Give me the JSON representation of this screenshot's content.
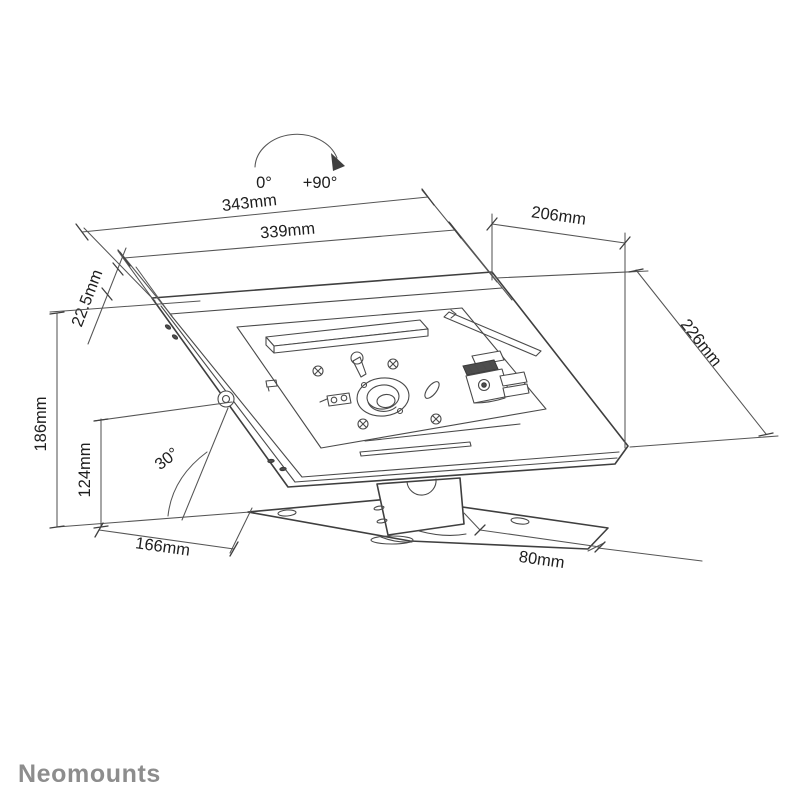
{
  "drawing": {
    "type": "technical-dimension-diagram",
    "subject": "tablet security enclosure countertop stand",
    "rotation_indicator": {
      "from": "0°",
      "to": "+90°"
    },
    "dimensions": {
      "width_outer": "343mm",
      "width_inner": "339mm",
      "top_depth": "206mm",
      "side_depth": "226mm",
      "enclosure_thickness": "22.5mm",
      "total_height": "186mm",
      "pivot_height": "124mm",
      "tilt_angle": "30°",
      "base_depth": "166mm",
      "base_offset": "80mm"
    },
    "footer": {
      "brand": "Neomounts"
    },
    "colors": {
      "line": "#3f3f3f",
      "dimension_text": "#1e1e1e",
      "brand": "#8d8d8d",
      "background": "#ffffff"
    }
  }
}
